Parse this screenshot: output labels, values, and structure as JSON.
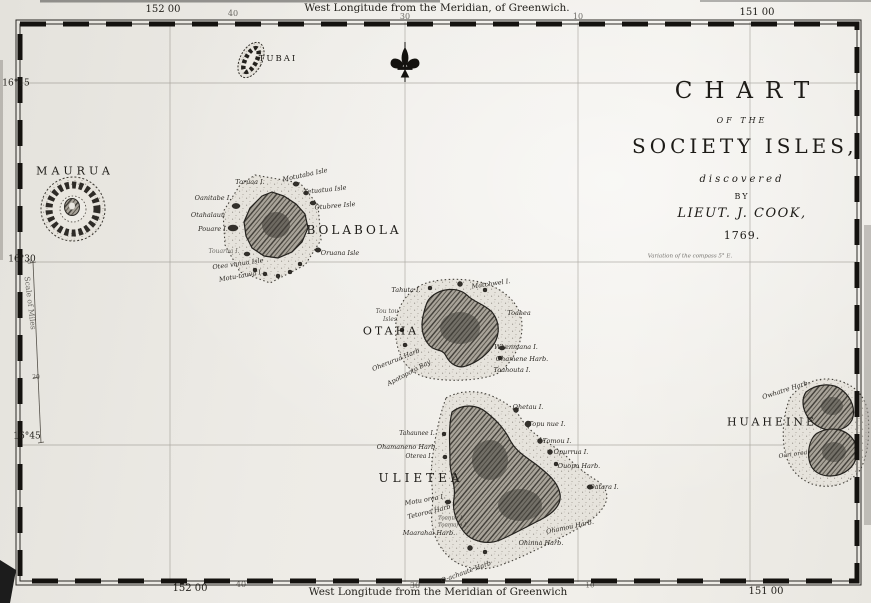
{
  "map": {
    "title_block": {
      "line1": "CHART",
      "line2": "OF THE",
      "line3": "SOCIETY ISLES,",
      "line4": "discovered",
      "line5": "BY",
      "line6": "LIEUT. J. COOK,",
      "line7": "1769."
    },
    "compass_note": "Variation of the compass 5° E.",
    "scale": {
      "label": "Scale of Miles",
      "tick_top": "0",
      "tick_mid": "20"
    },
    "labels": [
      {
        "text": "152 00",
        "x": 163,
        "y": 10,
        "fs": 10,
        "cls": "coord",
        "group": "border-top"
      },
      {
        "text": "40",
        "x": 233,
        "y": 14,
        "fs": 8,
        "cls": "coord faint",
        "group": "border-top"
      },
      {
        "text": "West Longitude from the Meridian, of Greenwich.",
        "x": 437,
        "y": 8,
        "fs": 10.5,
        "cls": "coord",
        "group": "border-top"
      },
      {
        "text": "30",
        "x": 405,
        "y": 17,
        "fs": 8,
        "cls": "coord faint",
        "group": "border-top"
      },
      {
        "text": "10",
        "x": 578,
        "y": 17,
        "fs": 8,
        "cls": "coord faint",
        "group": "border-top"
      },
      {
        "text": "151 00",
        "x": 757,
        "y": 13,
        "fs": 10,
        "cls": "coord",
        "group": "border-top"
      },
      {
        "text": "152 00",
        "x": 190,
        "y": 589,
        "fs": 10,
        "cls": "coord",
        "group": "border-bottom"
      },
      {
        "text": "40",
        "x": 241,
        "y": 585,
        "fs": 8,
        "cls": "coord faint",
        "group": "border-bottom"
      },
      {
        "text": "30",
        "x": 415,
        "y": 586,
        "fs": 8,
        "cls": "coord faint",
        "group": "border-bottom"
      },
      {
        "text": "West Longitude from the Meridian of Greenwich",
        "x": 438,
        "y": 592,
        "fs": 10.5,
        "cls": "coord",
        "group": "border-bottom"
      },
      {
        "text": "10",
        "x": 590,
        "y": 586,
        "fs": 7,
        "cls": "coord faint",
        "group": "border-bottom"
      },
      {
        "text": "151 00",
        "x": 766,
        "y": 592,
        "fs": 10,
        "cls": "coord",
        "group": "border-bottom"
      },
      {
        "text": "16°15",
        "x": 16,
        "y": 84,
        "fs": 9,
        "cls": "coord",
        "group": "border-left"
      },
      {
        "text": "16°30",
        "x": 22,
        "y": 260,
        "fs": 9,
        "cls": "coord",
        "group": "border-left"
      },
      {
        "text": "16°45",
        "x": 27,
        "y": 437,
        "fs": 9,
        "cls": "coord",
        "group": "border-left"
      },
      {
        "text": "Scale of Miles",
        "x": 30,
        "y": 303,
        "fs": 7.5,
        "rot": 83,
        "cls": "coord faint",
        "group": "scale"
      },
      {
        "text": "0",
        "x": 29,
        "y": 263,
        "fs": 6,
        "cls": "coord faint",
        "group": "scale"
      },
      {
        "text": "20",
        "x": 36,
        "y": 378,
        "fs": 6,
        "cls": "coord faint",
        "group": "scale"
      },
      {
        "text": "Variation of the compass 5° E.",
        "x": 690,
        "y": 257,
        "fs": 5.5,
        "cls": "faint",
        "group": "note"
      },
      {
        "text": "MAURUA",
        "x": 75,
        "y": 171,
        "fs": 11,
        "ls": 4,
        "cls": "caps",
        "group": "maurua"
      },
      {
        "text": "TUBAI",
        "x": 278,
        "y": 59,
        "fs": 8.5,
        "ls": 2,
        "cls": "caps",
        "group": "tubai"
      },
      {
        "text": "BOLABOLA",
        "x": 354,
        "y": 230,
        "fs": 12,
        "ls": 3,
        "cls": "caps",
        "group": "bolabola"
      },
      {
        "text": "OTAHA",
        "x": 391,
        "y": 331,
        "fs": 11,
        "ls": 3,
        "cls": "caps",
        "group": "otaha"
      },
      {
        "text": "ULIETEA",
        "x": 421,
        "y": 478,
        "fs": 12,
        "ls": 4,
        "cls": "caps",
        "group": "ulietea"
      },
      {
        "text": "HUAHEINE",
        "x": 772,
        "y": 422,
        "fs": 11,
        "ls": 3,
        "cls": "caps",
        "group": "huaheine"
      },
      {
        "text": "Toruaa I.",
        "x": 250,
        "y": 182,
        "fs": 6.5,
        "group": "bolabola"
      },
      {
        "text": "Motutaba Isle",
        "x": 305,
        "y": 175,
        "fs": 6.5,
        "rot": -12,
        "group": "bolabola"
      },
      {
        "text": "Tetuatua Isle",
        "x": 325,
        "y": 190,
        "fs": 6.5,
        "rot": -6,
        "group": "bolabola"
      },
      {
        "text": "Otubree Isle",
        "x": 335,
        "y": 206,
        "fs": 6.5,
        "rot": -5,
        "group": "bolabola"
      },
      {
        "text": "Oanitabe I.",
        "x": 213,
        "y": 198,
        "fs": 6.5,
        "group": "bolabola"
      },
      {
        "text": "Otahalauu",
        "x": 208,
        "y": 215,
        "fs": 6.5,
        "group": "bolabola"
      },
      {
        "text": "Pouare I.",
        "x": 213,
        "y": 229,
        "fs": 6.5,
        "group": "bolabola"
      },
      {
        "text": "Touarua I.",
        "x": 224,
        "y": 252,
        "fs": 6,
        "cls": "faint",
        "group": "bolabola"
      },
      {
        "text": "Otea vanua Isle",
        "x": 238,
        "y": 264,
        "fs": 6.5,
        "rot": -8,
        "group": "bolabola"
      },
      {
        "text": "Motu-tauva I.",
        "x": 241,
        "y": 276,
        "fs": 6.5,
        "rot": -10,
        "group": "bolabola"
      },
      {
        "text": "Oruana Isle",
        "x": 340,
        "y": 253,
        "fs": 6.5,
        "group": "bolabola"
      },
      {
        "text": "Tahuta I.",
        "x": 406,
        "y": 290,
        "fs": 6.5,
        "group": "otaha"
      },
      {
        "text": "Matchwel I.",
        "x": 491,
        "y": 284,
        "fs": 6.5,
        "rot": -8,
        "group": "otaha"
      },
      {
        "text": "Tou tou",
        "x": 387,
        "y": 312,
        "fs": 6,
        "cls": "tiny",
        "group": "otaha"
      },
      {
        "text": "Isles",
        "x": 390,
        "y": 320,
        "fs": 6,
        "cls": "tiny",
        "group": "otaha"
      },
      {
        "text": "Toahea",
        "x": 519,
        "y": 313,
        "fs": 6.5,
        "group": "otaha"
      },
      {
        "text": "Oherurua Harb",
        "x": 396,
        "y": 360,
        "fs": 6.5,
        "rot": -22,
        "group": "otaha"
      },
      {
        "text": "Apotopoto Bay",
        "x": 409,
        "y": 373,
        "fs": 6.5,
        "rot": -28,
        "group": "otaha"
      },
      {
        "text": "Whenmana I.",
        "x": 516,
        "y": 347,
        "fs": 6.5,
        "group": "otaha"
      },
      {
        "text": "Ohamene Harb.",
        "x": 522,
        "y": 359,
        "fs": 6.5,
        "group": "otaha"
      },
      {
        "text": "Toahouta I.",
        "x": 512,
        "y": 370,
        "fs": 6.5,
        "group": "otaha"
      },
      {
        "text": "Ohetau I.",
        "x": 528,
        "y": 407,
        "fs": 6.5,
        "group": "ulietea"
      },
      {
        "text": "Topu nue I.",
        "x": 547,
        "y": 424,
        "fs": 6.5,
        "group": "ulietea"
      },
      {
        "text": "Tomou I.",
        "x": 557,
        "y": 441,
        "fs": 6.5,
        "group": "ulietea"
      },
      {
        "text": "Opurrua I.",
        "x": 571,
        "y": 452,
        "fs": 6.5,
        "group": "ulietea"
      },
      {
        "text": "Ouopo Harb.",
        "x": 579,
        "y": 466,
        "fs": 6.5,
        "group": "ulietea"
      },
      {
        "text": "Oatara I.",
        "x": 604,
        "y": 487,
        "fs": 6.5,
        "group": "ulietea"
      },
      {
        "text": "Tahaunee I.",
        "x": 417,
        "y": 434,
        "fs": 6,
        "group": "ulietea"
      },
      {
        "text": "Ohamaneno Harb.",
        "x": 407,
        "y": 447,
        "fs": 6.5,
        "group": "ulietea"
      },
      {
        "text": "Oterea I.",
        "x": 419,
        "y": 457,
        "fs": 6,
        "group": "ulietea"
      },
      {
        "text": "Motu orea I.",
        "x": 425,
        "y": 500,
        "fs": 6.5,
        "rot": -10,
        "group": "ulietea"
      },
      {
        "text": "Tetoroa Harb",
        "x": 429,
        "y": 512,
        "fs": 6.5,
        "rot": -14,
        "group": "ulietea"
      },
      {
        "text": "Toanue I.",
        "x": 451,
        "y": 519,
        "fs": 5.5,
        "cls": "tiny",
        "group": "ulietea"
      },
      {
        "text": "Toamaro I.",
        "x": 453,
        "y": 526,
        "fs": 5.5,
        "cls": "tiny",
        "group": "ulietea"
      },
      {
        "text": "Maarahai Harb.",
        "x": 429,
        "y": 533,
        "fs": 6.5,
        "group": "ulietea"
      },
      {
        "text": "Ohamou Harb.",
        "x": 570,
        "y": 527,
        "fs": 6.5,
        "rot": -12,
        "group": "ulietea"
      },
      {
        "text": "Ohinna Harb.",
        "x": 541,
        "y": 543,
        "fs": 6.5,
        "group": "ulietea"
      },
      {
        "text": "O-achaute Harb",
        "x": 466,
        "y": 572,
        "fs": 6.5,
        "rot": -20,
        "group": "ulietea"
      },
      {
        "text": "Owhatre Harb.",
        "x": 786,
        "y": 390,
        "fs": 6.5,
        "rot": -18,
        "group": "huaheine"
      },
      {
        "text": "Oari orea",
        "x": 793,
        "y": 455,
        "fs": 6,
        "rot": -8,
        "group": "huaheine"
      }
    ],
    "colors": {
      "paper": "#edebe6",
      "ink": "#1d1b17",
      "reef_dot": "#44413b",
      "land_dark": "#3e3b35"
    }
  }
}
